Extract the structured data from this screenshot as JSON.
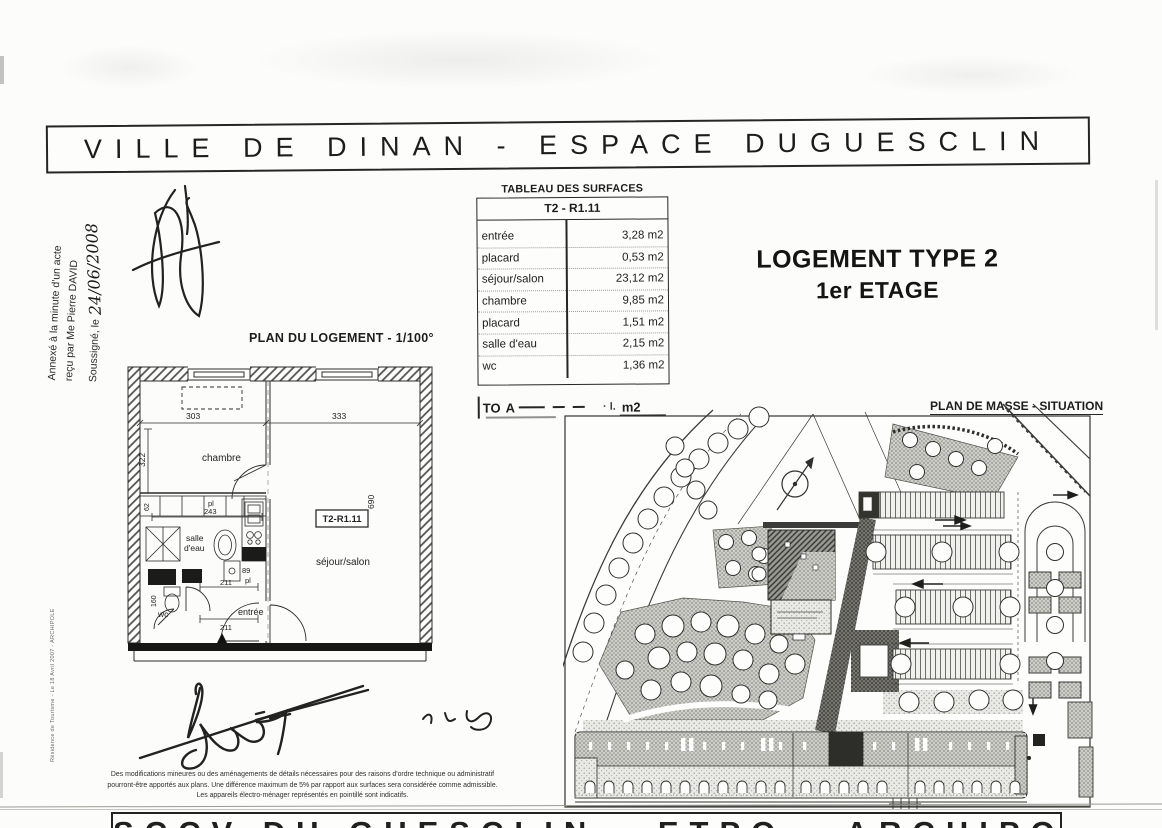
{
  "colors": {
    "paper": "#fcfcfa",
    "ink": "#1d1d1b"
  },
  "title_banner": "VILLE DE DINAN - ESPACE DUGUESCLIN",
  "notary_annotation": {
    "line1": "Annexé à la minute d'un acte",
    "line2": "reçu par Me Pierre DAVID",
    "line3_prefix": "Soussigné, le",
    "handwritten_date": "24/06/2008"
  },
  "surfaces_table": {
    "title": "TABLEAU DES SURFACES",
    "unit_header": "T2 - R1.11",
    "rows": [
      {
        "label": "entrée",
        "value": "3,28 m2"
      },
      {
        "label": "placard",
        "value": "0,53 m2"
      },
      {
        "label": "séjour/salon",
        "value": "23,12 m2"
      },
      {
        "label": "chambre",
        "value": "9,85 m2"
      },
      {
        "label": "placard",
        "value": "1,51 m2"
      },
      {
        "label": "salle d'eau",
        "value": "2,15 m2"
      },
      {
        "label": "wc",
        "value": "1,36 m2"
      }
    ],
    "total_label_fragment": "TO",
    "total_label_fragment2": "A",
    "total_value_fragment": "m2"
  },
  "logement_heading": {
    "line1": "LOGEMENT TYPE 2",
    "line2": "1er ETAGE"
  },
  "floor_plan": {
    "title": "PLAN DU LOGEMENT - 1/100°",
    "unit_tag": "T2-R1.11",
    "rooms": {
      "chambre": "chambre",
      "sejour": "séjour/salon",
      "salle_line1": "salle",
      "salle_line2": "d'eau",
      "wc": "wc",
      "entree": "entrée"
    },
    "dims": {
      "d303": "303",
      "d333": "333",
      "d322": "322",
      "d690": "690",
      "d243": "243",
      "d62": "62",
      "d89": "89",
      "d160": "160",
      "d211a": "211",
      "d211b": "211",
      "pl_a": "pl",
      "pl_b": "pl"
    }
  },
  "site_plan": {
    "title": "PLAN DE MASSE - SITUATION"
  },
  "footer_note": {
    "line1": "Des modifications mineures ou des aménagements de détails nécessaires pour des raisons d'ordre technique ou administratif",
    "line2": "pourront-être apportés aux plans. Une différence maximum de 5% par rapport aux surfaces sera considérée comme admissible.",
    "line3": "Les appareils électro-ménager représentés en pointillé sont indicatifs."
  },
  "footer_banner": "SCCV DU GUESCLIN - ETPO - ARCHIPOLE",
  "edge_note": "Résidence de Tourisme - Le 18 Avril 2007 - ARCHIPOLE"
}
